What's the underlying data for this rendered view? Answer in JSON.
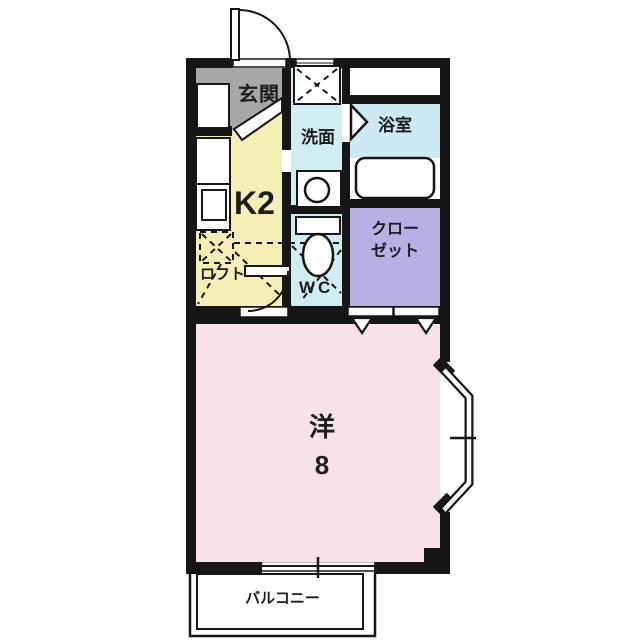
{
  "plan": {
    "type": "apartment-floorplan",
    "rooms": {
      "genkan": {
        "label": "玄関",
        "color": "#a7a7a7"
      },
      "kitchen": {
        "label": "K2",
        "color": "#f6efb5"
      },
      "loft": {
        "label": "ロフト"
      },
      "washroom": {
        "label": "洗面",
        "color": "#d0edf4"
      },
      "wc": {
        "label": "WC",
        "color": "#d0edf4"
      },
      "bathroom": {
        "label": "浴室",
        "color": "#cdeaf2"
      },
      "closet": {
        "label": "クロー\nゼット",
        "color": "#b7b1e3"
      },
      "western_room": {
        "label": "洋\n8",
        "color": "#f7e1ea"
      },
      "balcony": {
        "label": "バルコニー",
        "color": "#ffffff"
      }
    },
    "colors": {
      "wall": "#161616",
      "fixture": "#ffffff",
      "background": "#ffffff"
    }
  }
}
